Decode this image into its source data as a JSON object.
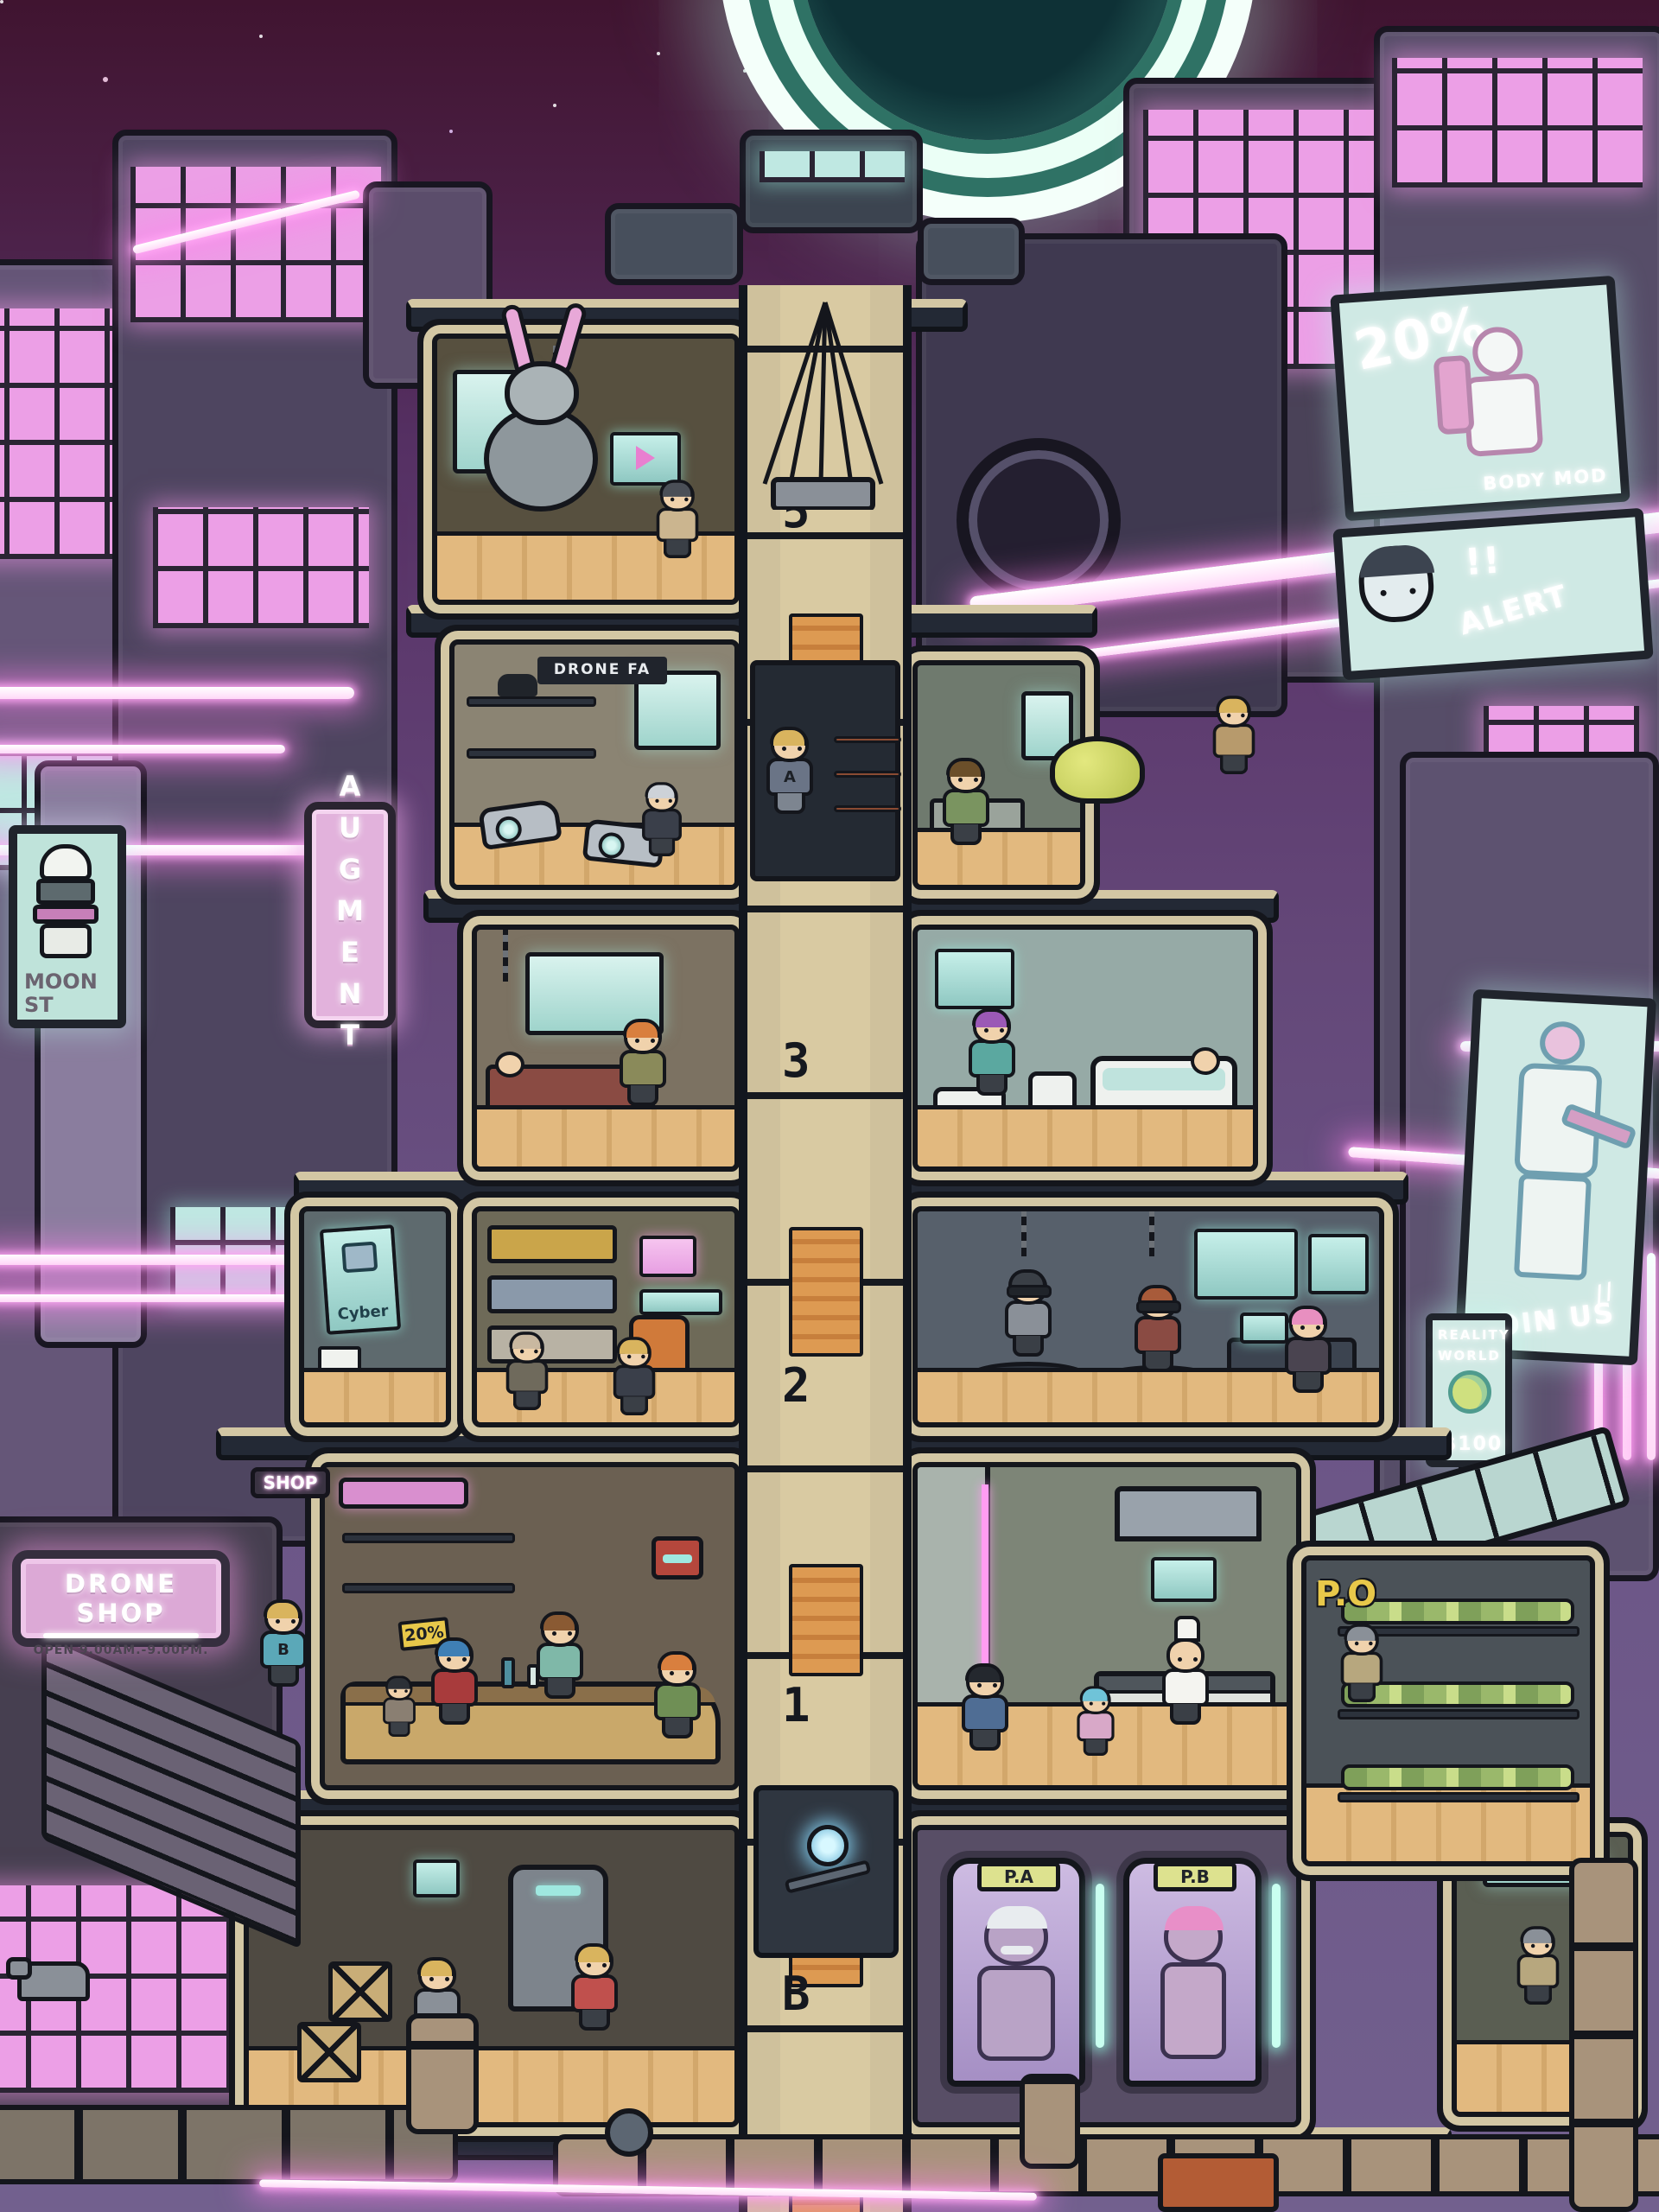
{
  "colors": {
    "neon_pink": "#ffb3f2",
    "sign_pink": "#dca9d6",
    "screen_teal": "#cdece6",
    "shaft_beige": "#cfc19c",
    "stripe_orange": "#dd9a52",
    "pod_label_green": "#dde28f",
    "sky_top": "#401430",
    "moon_teal": "#2f7265"
  },
  "billboards": {
    "moon_st": {
      "line1": "MOON",
      "line2": "ST"
    },
    "body_mod": {
      "discount": "20%",
      "caption": "BODY MOD"
    },
    "alert": {
      "exclaim": "!!",
      "label": "ALERT"
    },
    "join_us": {
      "marks": "//",
      "label": "JOIN US"
    },
    "reality_world": {
      "line1": "REALITY",
      "line2": "WORLD",
      "price": "$100"
    }
  },
  "signs": {
    "augment": "AUGMENT",
    "shop": "SHOP",
    "drone_shop_title": "DRONE SHOP",
    "drone_shop_hours": "OPEN 9.00AM.-9.00PM.",
    "drone_fa": "DRONE FA",
    "po": "P.O",
    "cyber_poster": "Cyber",
    "park_poster": "Park",
    "discount_tag": "20%"
  },
  "elevator": {
    "floor_labels": [
      "5",
      "3",
      "2",
      "1",
      "B"
    ]
  },
  "pods": {
    "a": "P.A",
    "b": "P.B"
  },
  "characters": {
    "shirt_letter_a": "A",
    "shirt_letter_b": "B"
  }
}
